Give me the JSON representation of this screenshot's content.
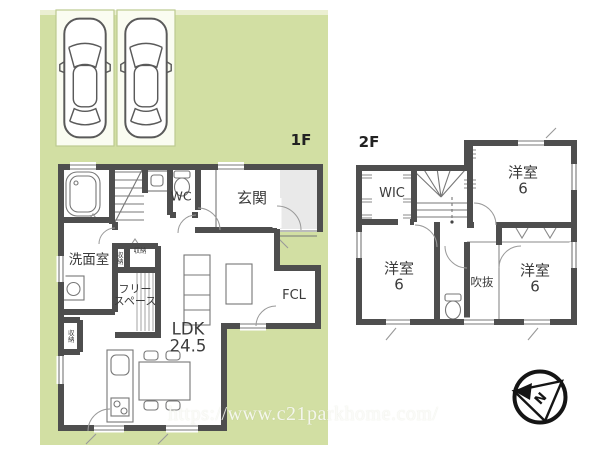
{
  "site": {
    "background_color": "#d2dfa3",
    "highlight_color": "#ebefd2",
    "wall_color": "#4e4e4e"
  },
  "parking": {
    "stall_count": "2",
    "car_icon": "car-top-view"
  },
  "floor1": {
    "label": "1F",
    "rooms": {
      "genkan": "玄関",
      "wc": "WC",
      "senmenshitsu": "洗面室",
      "storage1": "収納",
      "storage2": "収納",
      "storage3": "収納",
      "free_space": "フリー\nスペース",
      "ldk": "LDK\n24.5",
      "fcl": "FCL"
    }
  },
  "floor2": {
    "label": "2F",
    "rooms": {
      "wic": "WIC",
      "bedroom_top_right": "洋室\n6",
      "bedroom_left": "洋室\n6",
      "bedroom_bottom_right": "洋室\n6",
      "void": "吹抜"
    }
  },
  "compass": {
    "letter": "N"
  },
  "watermark": {
    "text": "https://www.c21parkhome.com/"
  }
}
